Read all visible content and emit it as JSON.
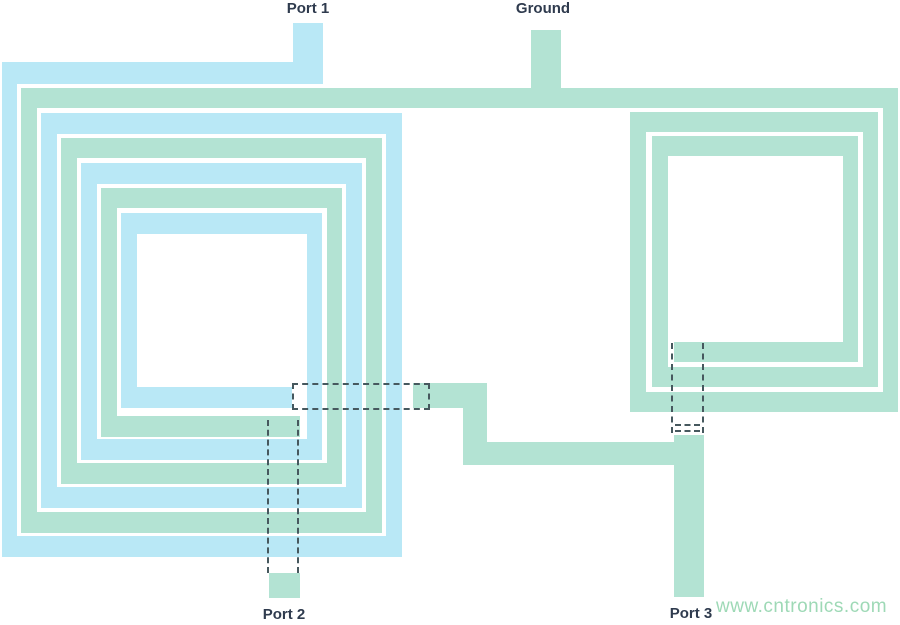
{
  "canvas": {
    "width": 900,
    "height": 625,
    "background": "#ffffff"
  },
  "colors": {
    "primary_trace": "#b9e8f6",
    "secondary_trace": "#b3e3d3",
    "underpass_dash": "#46585e",
    "label_text": "#2f3b4e",
    "watermark_text": "#9ed9b6"
  },
  "labels": {
    "port1": {
      "text": "Port 1",
      "x": 308,
      "y": 0
    },
    "ground": {
      "text": "Ground",
      "x": 543,
      "y": 0
    },
    "port2": {
      "text": "Port 2",
      "x": 284,
      "y": 606
    },
    "port3": {
      "text": "Port 3",
      "x": 691,
      "y": 605
    }
  },
  "watermark": {
    "text": "www.cntronics.com",
    "x": 716,
    "y": 596
  },
  "traces": [
    {
      "name": "port1-lead",
      "color": "blue",
      "x": 293,
      "y": 23,
      "w": 30,
      "h": 42
    },
    {
      "name": "primary-top-1",
      "color": "blue",
      "x": 2,
      "y": 62,
      "w": 321,
      "h": 22
    },
    {
      "name": "primary-left-1",
      "color": "blue",
      "x": 2,
      "y": 62,
      "w": 15,
      "h": 495
    },
    {
      "name": "primary-bottom-1",
      "color": "blue",
      "x": 2,
      "y": 536,
      "w": 400,
      "h": 21
    },
    {
      "name": "primary-right-1",
      "color": "blue",
      "x": 386,
      "y": 113,
      "w": 16,
      "h": 444
    },
    {
      "name": "primary-top-2",
      "color": "blue",
      "x": 41,
      "y": 113,
      "w": 361,
      "h": 21
    },
    {
      "name": "primary-left-2",
      "color": "blue",
      "x": 41,
      "y": 113,
      "w": 16,
      "h": 395
    },
    {
      "name": "primary-bottom-2",
      "color": "blue",
      "x": 41,
      "y": 487,
      "w": 321,
      "h": 21
    },
    {
      "name": "primary-right-2",
      "color": "blue",
      "x": 346,
      "y": 163,
      "w": 16,
      "h": 345
    },
    {
      "name": "primary-top-3",
      "color": "blue",
      "x": 81,
      "y": 163,
      "w": 281,
      "h": 21
    },
    {
      "name": "primary-left-3",
      "color": "blue",
      "x": 81,
      "y": 163,
      "w": 16,
      "h": 297
    },
    {
      "name": "primary-bottom-3",
      "color": "blue",
      "x": 81,
      "y": 439,
      "w": 241,
      "h": 21
    },
    {
      "name": "primary-right-3",
      "color": "blue",
      "x": 307,
      "y": 213,
      "w": 15,
      "h": 247
    },
    {
      "name": "primary-top-4",
      "color": "blue",
      "x": 121,
      "y": 213,
      "w": 201,
      "h": 21
    },
    {
      "name": "primary-left-4",
      "color": "blue",
      "x": 121,
      "y": 213,
      "w": 16,
      "h": 195
    },
    {
      "name": "primary-inner-stub",
      "color": "blue",
      "x": 121,
      "y": 387,
      "w": 171,
      "h": 21
    },
    {
      "name": "secondary-top-long",
      "color": "green",
      "x": 21,
      "y": 88,
      "w": 877,
      "h": 20
    },
    {
      "name": "ground-lead",
      "color": "green",
      "x": 531,
      "y": 30,
      "w": 30,
      "h": 60
    },
    {
      "name": "secondary-left-1",
      "color": "green",
      "x": 21,
      "y": 88,
      "w": 16,
      "h": 445
    },
    {
      "name": "secondary-bottom-1",
      "color": "green",
      "x": 21,
      "y": 512,
      "w": 361,
      "h": 21
    },
    {
      "name": "secondary-right-1",
      "color": "green",
      "x": 366,
      "y": 138,
      "w": 16,
      "h": 395
    },
    {
      "name": "secondary-top-2",
      "color": "green",
      "x": 61,
      "y": 138,
      "w": 321,
      "h": 20
    },
    {
      "name": "secondary-left-2",
      "color": "green",
      "x": 61,
      "y": 138,
      "w": 16,
      "h": 346
    },
    {
      "name": "secondary-bottom-2",
      "color": "green",
      "x": 61,
      "y": 463,
      "w": 281,
      "h": 21
    },
    {
      "name": "secondary-right-2",
      "color": "green",
      "x": 327,
      "y": 188,
      "w": 15,
      "h": 296
    },
    {
      "name": "secondary-top-3",
      "color": "green",
      "x": 101,
      "y": 188,
      "w": 241,
      "h": 20
    },
    {
      "name": "secondary-left-3",
      "color": "green",
      "x": 101,
      "y": 188,
      "w": 16,
      "h": 249
    },
    {
      "name": "secondary-bottom-3",
      "color": "green",
      "x": 101,
      "y": 416,
      "w": 199,
      "h": 21
    },
    {
      "name": "port2-pad",
      "color": "green",
      "x": 269,
      "y": 573,
      "w": 31,
      "h": 25
    },
    {
      "name": "right-coil-right-1",
      "color": "green",
      "x": 883,
      "y": 88,
      "w": 15,
      "h": 324
    },
    {
      "name": "right-coil-bottom-1",
      "color": "green",
      "x": 630,
      "y": 392,
      "w": 268,
      "h": 20
    },
    {
      "name": "right-coil-left-1",
      "color": "green",
      "x": 630,
      "y": 112,
      "w": 16,
      "h": 300
    },
    {
      "name": "right-coil-top-2",
      "color": "green",
      "x": 630,
      "y": 112,
      "w": 248,
      "h": 20
    },
    {
      "name": "right-coil-right-2",
      "color": "green",
      "x": 863,
      "y": 112,
      "w": 15,
      "h": 275
    },
    {
      "name": "right-coil-bottom-2",
      "color": "green",
      "x": 652,
      "y": 367,
      "w": 226,
      "h": 20
    },
    {
      "name": "right-coil-left-2",
      "color": "green",
      "x": 652,
      "y": 136,
      "w": 16,
      "h": 251
    },
    {
      "name": "right-coil-top-3",
      "color": "green",
      "x": 652,
      "y": 136,
      "w": 206,
      "h": 20
    },
    {
      "name": "right-coil-right-3",
      "color": "green",
      "x": 843,
      "y": 136,
      "w": 15,
      "h": 226
    },
    {
      "name": "right-coil-bottom-3",
      "color": "green",
      "x": 674,
      "y": 342,
      "w": 184,
      "h": 20
    },
    {
      "name": "connector-h1",
      "color": "green",
      "x": 413,
      "y": 383,
      "w": 74,
      "h": 25
    },
    {
      "name": "connector-v",
      "color": "green",
      "x": 463,
      "y": 383,
      "w": 24,
      "h": 82
    },
    {
      "name": "connector-h2",
      "color": "green",
      "x": 463,
      "y": 442,
      "w": 211,
      "h": 23
    },
    {
      "name": "port3-lead",
      "color": "green",
      "x": 674,
      "y": 435,
      "w": 30,
      "h": 162
    }
  ],
  "underpasses": [
    {
      "name": "underpass-center-box",
      "type": "rect",
      "x": 292,
      "y": 383,
      "w": 138,
      "h": 27
    },
    {
      "name": "underpass-port2-line-left",
      "type": "vline",
      "x": 267,
      "y": 420,
      "h": 153
    },
    {
      "name": "underpass-port2-line-right",
      "type": "vline",
      "x": 297,
      "y": 420,
      "h": 153
    },
    {
      "name": "underpass-port3-line-left",
      "type": "vline",
      "x": 671,
      "y": 343,
      "h": 90
    },
    {
      "name": "underpass-port3-line-right",
      "type": "vline",
      "x": 702,
      "y": 343,
      "h": 90
    },
    {
      "name": "underpass-port3-tick-1",
      "type": "hline",
      "x": 675,
      "y": 424,
      "w": 25
    },
    {
      "name": "underpass-port3-tick-2",
      "type": "hline",
      "x": 675,
      "y": 430,
      "w": 25
    }
  ]
}
